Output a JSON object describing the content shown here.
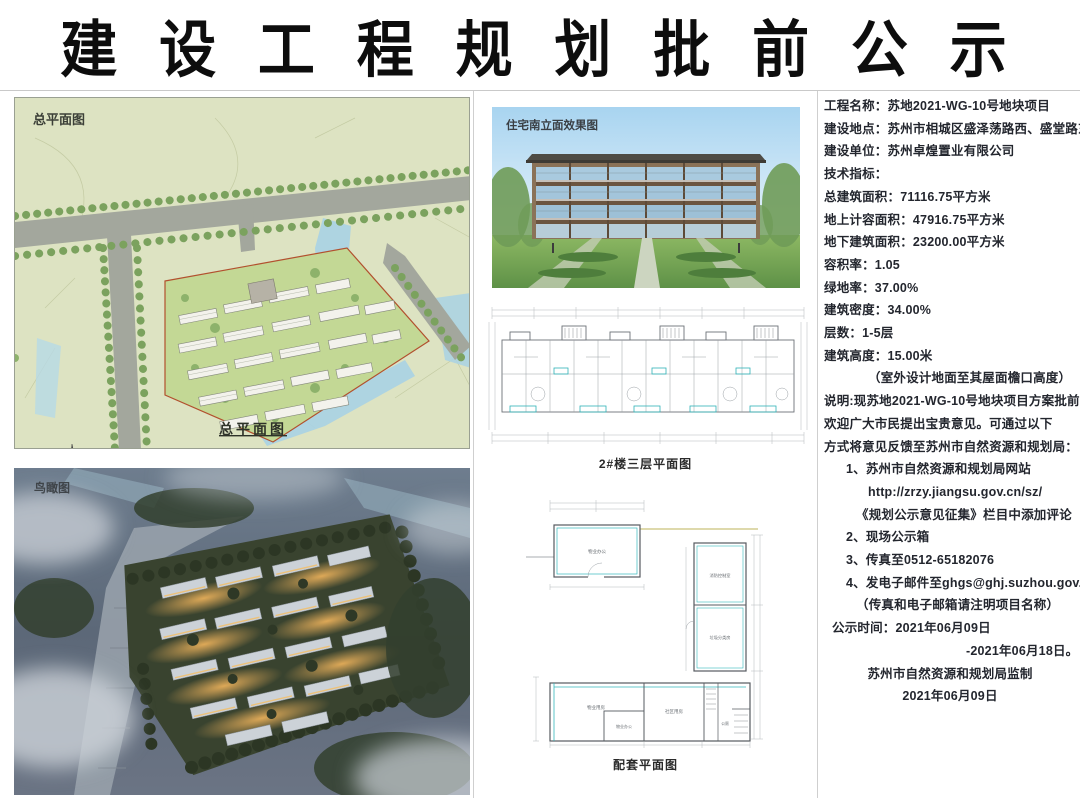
{
  "title": "建 设 工 程 规 划 批 前 公 示",
  "left_panel": {
    "site_plan": {
      "corner_label": "总平面图",
      "caption": "总平面图"
    },
    "aerial": {
      "corner_label": "鸟瞰图"
    }
  },
  "middle_panel": {
    "rendering": {
      "corner_label": "住宅南立面效果图"
    },
    "floor_plan": {
      "caption": "2#楼三层平面图"
    },
    "amenity_plan": {
      "caption": "配套平面图",
      "rooms": {
        "top": "物业办公",
        "right_top": "消防控制室",
        "right_bottom": "垃圾分类房",
        "bottom_left": "物业用房",
        "bottom_inner": "物业办公",
        "bottom_right": "社区用房",
        "toilet": "公厕"
      }
    }
  },
  "info_panel": {
    "lines": [
      {
        "text": "工程名称：苏地2021-WG-10号地块项目",
        "cls": ""
      },
      {
        "text": "建设地点：苏州市相城区盛泽荡路西、盛堂路东",
        "cls": ""
      },
      {
        "text": "建设单位：苏州卓煌置业有限公司",
        "cls": ""
      },
      {
        "text": "技术指标：",
        "cls": ""
      },
      {
        "text": "总建筑面积：71116.75平方米",
        "cls": ""
      },
      {
        "text": "地上计容面积：47916.75平方米",
        "cls": ""
      },
      {
        "text": "地下建筑面积：23200.00平方米",
        "cls": ""
      },
      {
        "text": "容积率：1.05",
        "cls": ""
      },
      {
        "text": "绿地率：37.00%",
        "cls": ""
      },
      {
        "text": "建筑密度：34.00%",
        "cls": ""
      },
      {
        "text": "层数：1-5层",
        "cls": ""
      },
      {
        "text": "建筑高度：15.00米",
        "cls": ""
      },
      {
        "text": "（室外设计地面至其屋面檐口高度）",
        "cls": "ind2"
      },
      {
        "text": "说明:现苏地2021-WG-10号地块项目方案批前公示。",
        "cls": ""
      },
      {
        "text": "欢迎广大市民提出宝贵意见。可通过以下",
        "cls": ""
      },
      {
        "text": "方式将意见反馈至苏州市自然资源和规划局：",
        "cls": ""
      },
      {
        "text": "1、苏州市自然资源和规划局网站",
        "cls": "ind1"
      },
      {
        "text": "http://zrzy.jiangsu.gov.cn/sz/",
        "cls": "ind2"
      },
      {
        "text": "《规划公示意见征集》栏目中添加评论",
        "cls": "ind15"
      },
      {
        "text": "2、现场公示箱",
        "cls": "ind1"
      },
      {
        "text": "3、传真至0512-65182076",
        "cls": "ind1"
      },
      {
        "text": "4、发电子邮件至ghgs@ghj.suzhou.gov.cn",
        "cls": "ind1"
      },
      {
        "text": "（传真和电子邮箱请注明项目名称）",
        "cls": "ind15"
      },
      {
        "text": "公示时间：2021年06月09日",
        "cls": "ind05"
      },
      {
        "text": "-2021年06月18日。",
        "cls": "right-mid"
      },
      {
        "text": "苏州市自然资源和规划局监制",
        "cls": "center"
      },
      {
        "text": "2021年06月09日",
        "cls": "center"
      }
    ]
  }
}
